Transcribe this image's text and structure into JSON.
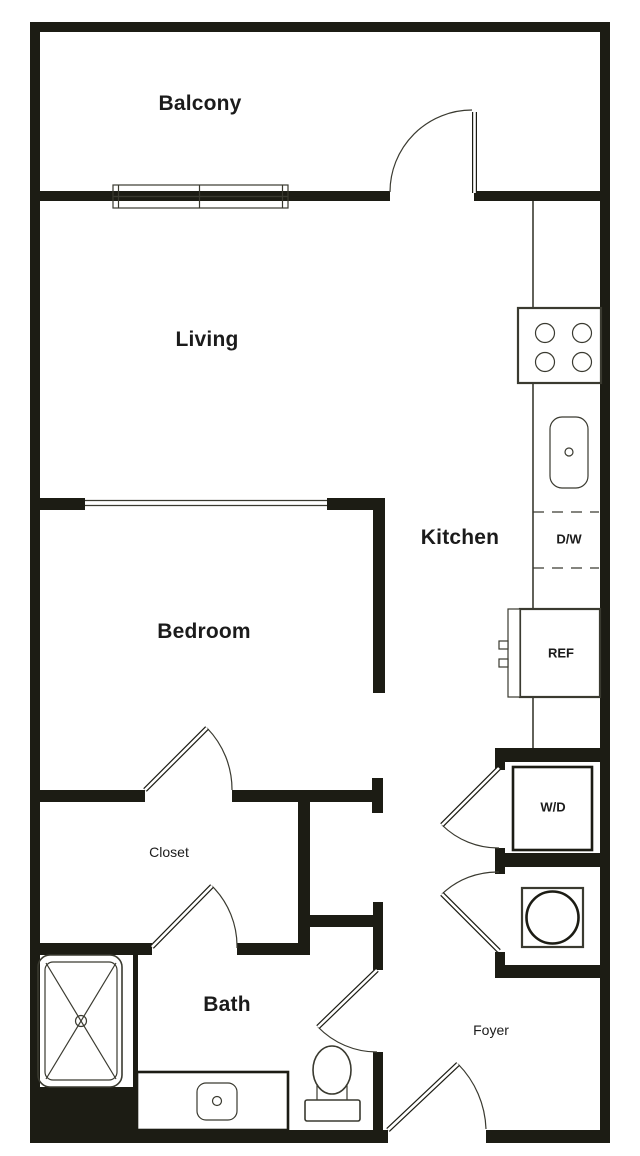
{
  "rooms": {
    "balcony": "Balcony",
    "living": "Living",
    "kitchen": "Kitchen",
    "bedroom": "Bedroom",
    "closet": "Closet",
    "bath": "Bath",
    "foyer": "Foyer"
  },
  "appliances": {
    "dishwasher": "D/W",
    "refrigerator": "REF",
    "washer_dryer": "W/D"
  },
  "colors": {
    "wall": "#1c1c14",
    "line": "#3a3a30",
    "background": "#ffffff",
    "text": "#1b1b1b"
  }
}
